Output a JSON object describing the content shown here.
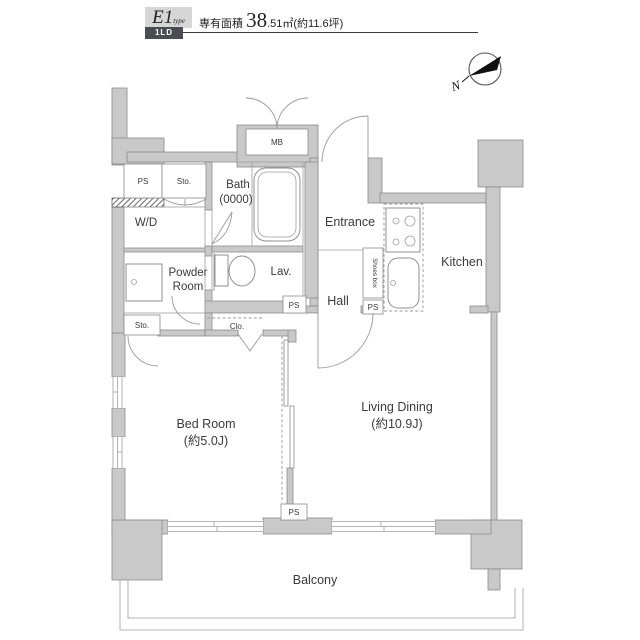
{
  "header": {
    "plan_type": "E1",
    "plan_type_suffix": "type",
    "badge": "1LD",
    "area_label": "専有面積 ",
    "area_value_int": "38",
    "area_value_rest": ".51㎡",
    "area_tsubo": "(約11.6坪)"
  },
  "compass": {
    "north_letter": "N"
  },
  "labels": {
    "entrance": "Entrance",
    "hall": "Hall",
    "kitchen": "Kitchen",
    "bath": "Bath",
    "bath_size": "(0000)",
    "lav": "Lav.",
    "wd": "W/D",
    "powder_line1": "Powder",
    "powder_line2": "Room",
    "bedroom": "Bed Room",
    "bedroom_size": "(約5.0J)",
    "living": "Living Dining",
    "living_size": "(約10.9J)",
    "balcony": "Balcony",
    "mb": "MB",
    "sto_upper": "Sto.",
    "sto_lower": "Sto.",
    "clo": "Clo.",
    "shoes_box": "Shoes box",
    "ps_upper_left": "PS",
    "ps_hallway": "PS",
    "ps_entrance": "PS",
    "ps_balcony": "PS"
  },
  "colors": {
    "wall_fill": "#c9c9c9",
    "wall_stroke": "#8a8a8a",
    "line": "#8f8f8f",
    "text": "#3a3a3a",
    "badge_bg": "#4b4b53",
    "logo_bg": "#d6d6d6"
  }
}
